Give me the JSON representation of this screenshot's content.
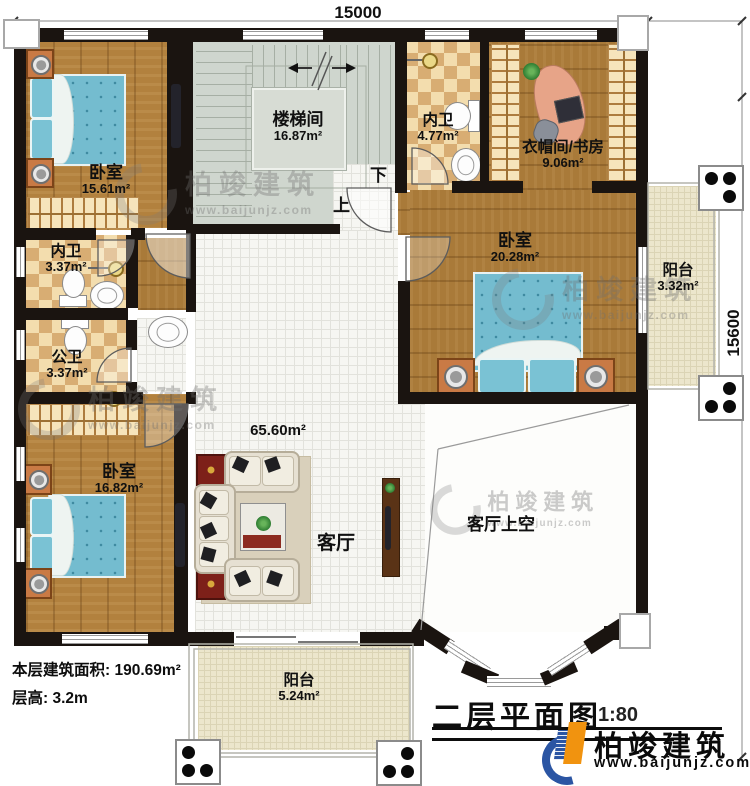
{
  "dimensions": {
    "top": "15000",
    "right": "15600"
  },
  "rooms": {
    "bedroom_tl": {
      "name": "卧室",
      "area": "15.61m²"
    },
    "stairwell": {
      "name": "楼梯间",
      "area": "16.87m²"
    },
    "bath_top": {
      "name": "内卫",
      "area": "4.77m²"
    },
    "cloak_study": {
      "name": "衣帽间/书房",
      "area": "9.06m²"
    },
    "bedroom_r": {
      "name": "卧室",
      "area": "20.28m²"
    },
    "balcony_r": {
      "name": "阳台",
      "area": "3.32m²"
    },
    "bath_mid": {
      "name": "内卫",
      "area": "3.37m²"
    },
    "bath_public": {
      "name": "公卫",
      "area": "3.37m²"
    },
    "bedroom_bl": {
      "name": "卧室",
      "area": "16.82m²"
    },
    "living": {
      "name": "客厅",
      "area": "65.60m²"
    },
    "living_void": {
      "name": "客厅上空"
    },
    "balcony_b": {
      "name": "阳台",
      "area": "5.24m²"
    }
  },
  "stairs": {
    "up": "上",
    "down": "下"
  },
  "footer": {
    "area_label": "本层建筑面积:",
    "area_value": "190.69m²",
    "height_label": "层高:",
    "height_value": "3.2m"
  },
  "title": {
    "text": "二层平面图",
    "scale": "1:80"
  },
  "brand": {
    "name": "柏竣建筑",
    "url": "www.baijunjz.com"
  },
  "watermark": {
    "name": "柏竣建筑",
    "url": "www.baijunjz.com"
  },
  "colors": {
    "wall": "#1a1410",
    "wood": "#b2813e",
    "stair": "#cfd6ce",
    "balcony": "#ece6cc",
    "checker": "#d8ad73",
    "bed": "#74bccf",
    "brand_blue": "#2b55a3",
    "brand_orange": "#f1930f"
  }
}
